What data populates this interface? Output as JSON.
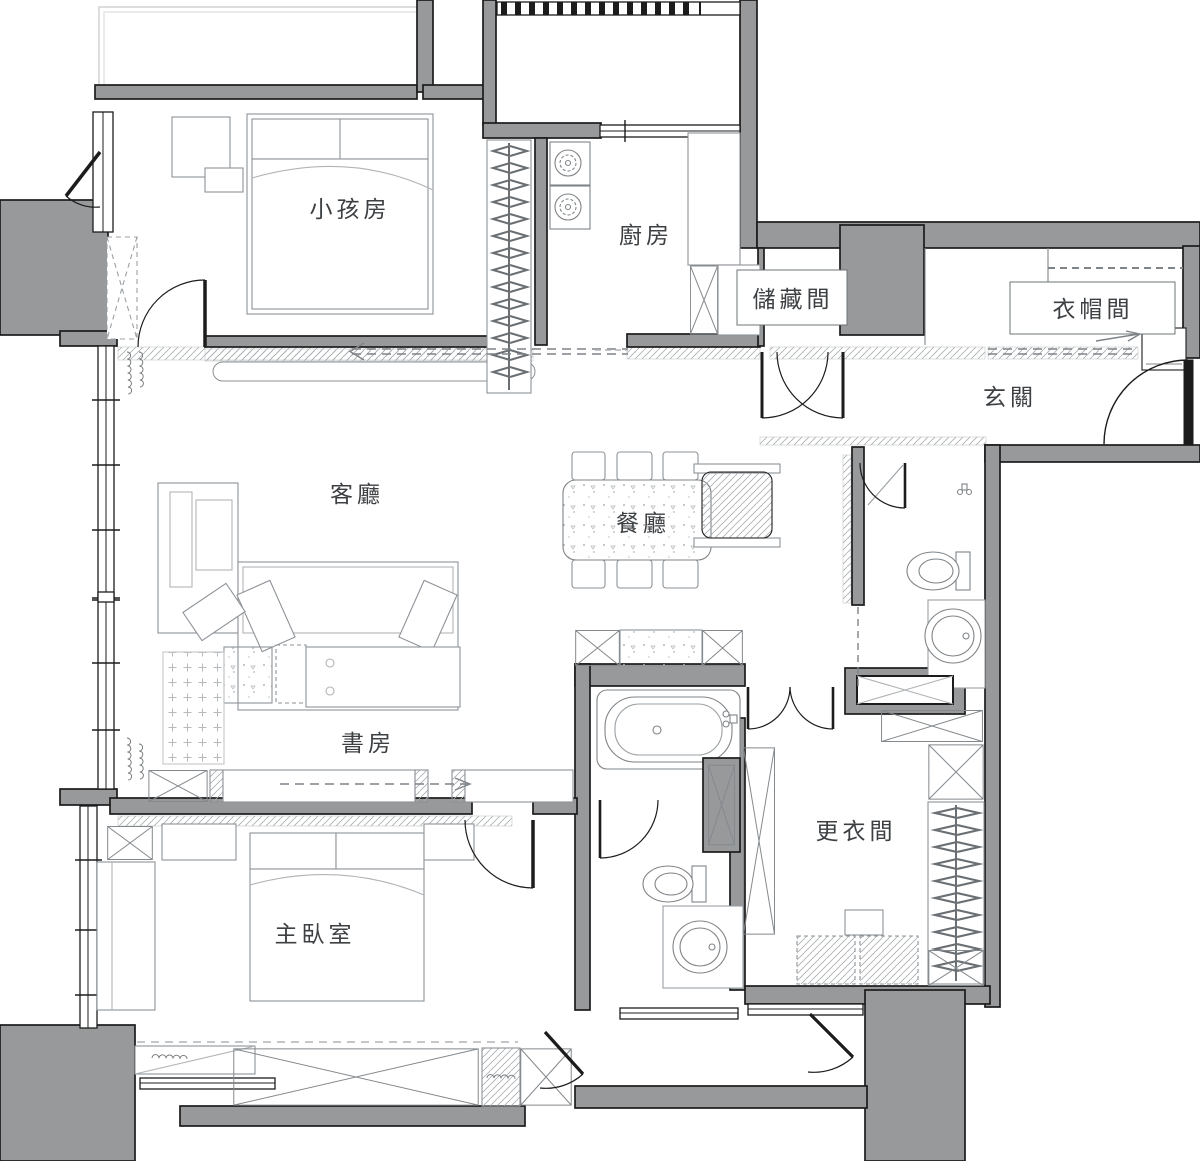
{
  "plan": {
    "title": "apartment-floor-plan",
    "rooms": [
      {
        "id": "kids-room",
        "label": "小孩房"
      },
      {
        "id": "kitchen",
        "label": "廚房"
      },
      {
        "id": "storage",
        "label": "儲藏間"
      },
      {
        "id": "cloakroom",
        "label": "衣帽間"
      },
      {
        "id": "foyer",
        "label": "玄關"
      },
      {
        "id": "living-room",
        "label": "客廳"
      },
      {
        "id": "dining-room",
        "label": "餐廳"
      },
      {
        "id": "study",
        "label": "書房"
      },
      {
        "id": "master-bedroom",
        "label": "主臥室"
      },
      {
        "id": "dressing-room",
        "label": "更衣間"
      }
    ],
    "colors": {
      "wall": "#97999b",
      "line": "#1c1c1c",
      "furniture": "#8e9398",
      "hatch": "#aaadb0",
      "text": "#3d4043",
      "background": "#ffffff"
    }
  }
}
